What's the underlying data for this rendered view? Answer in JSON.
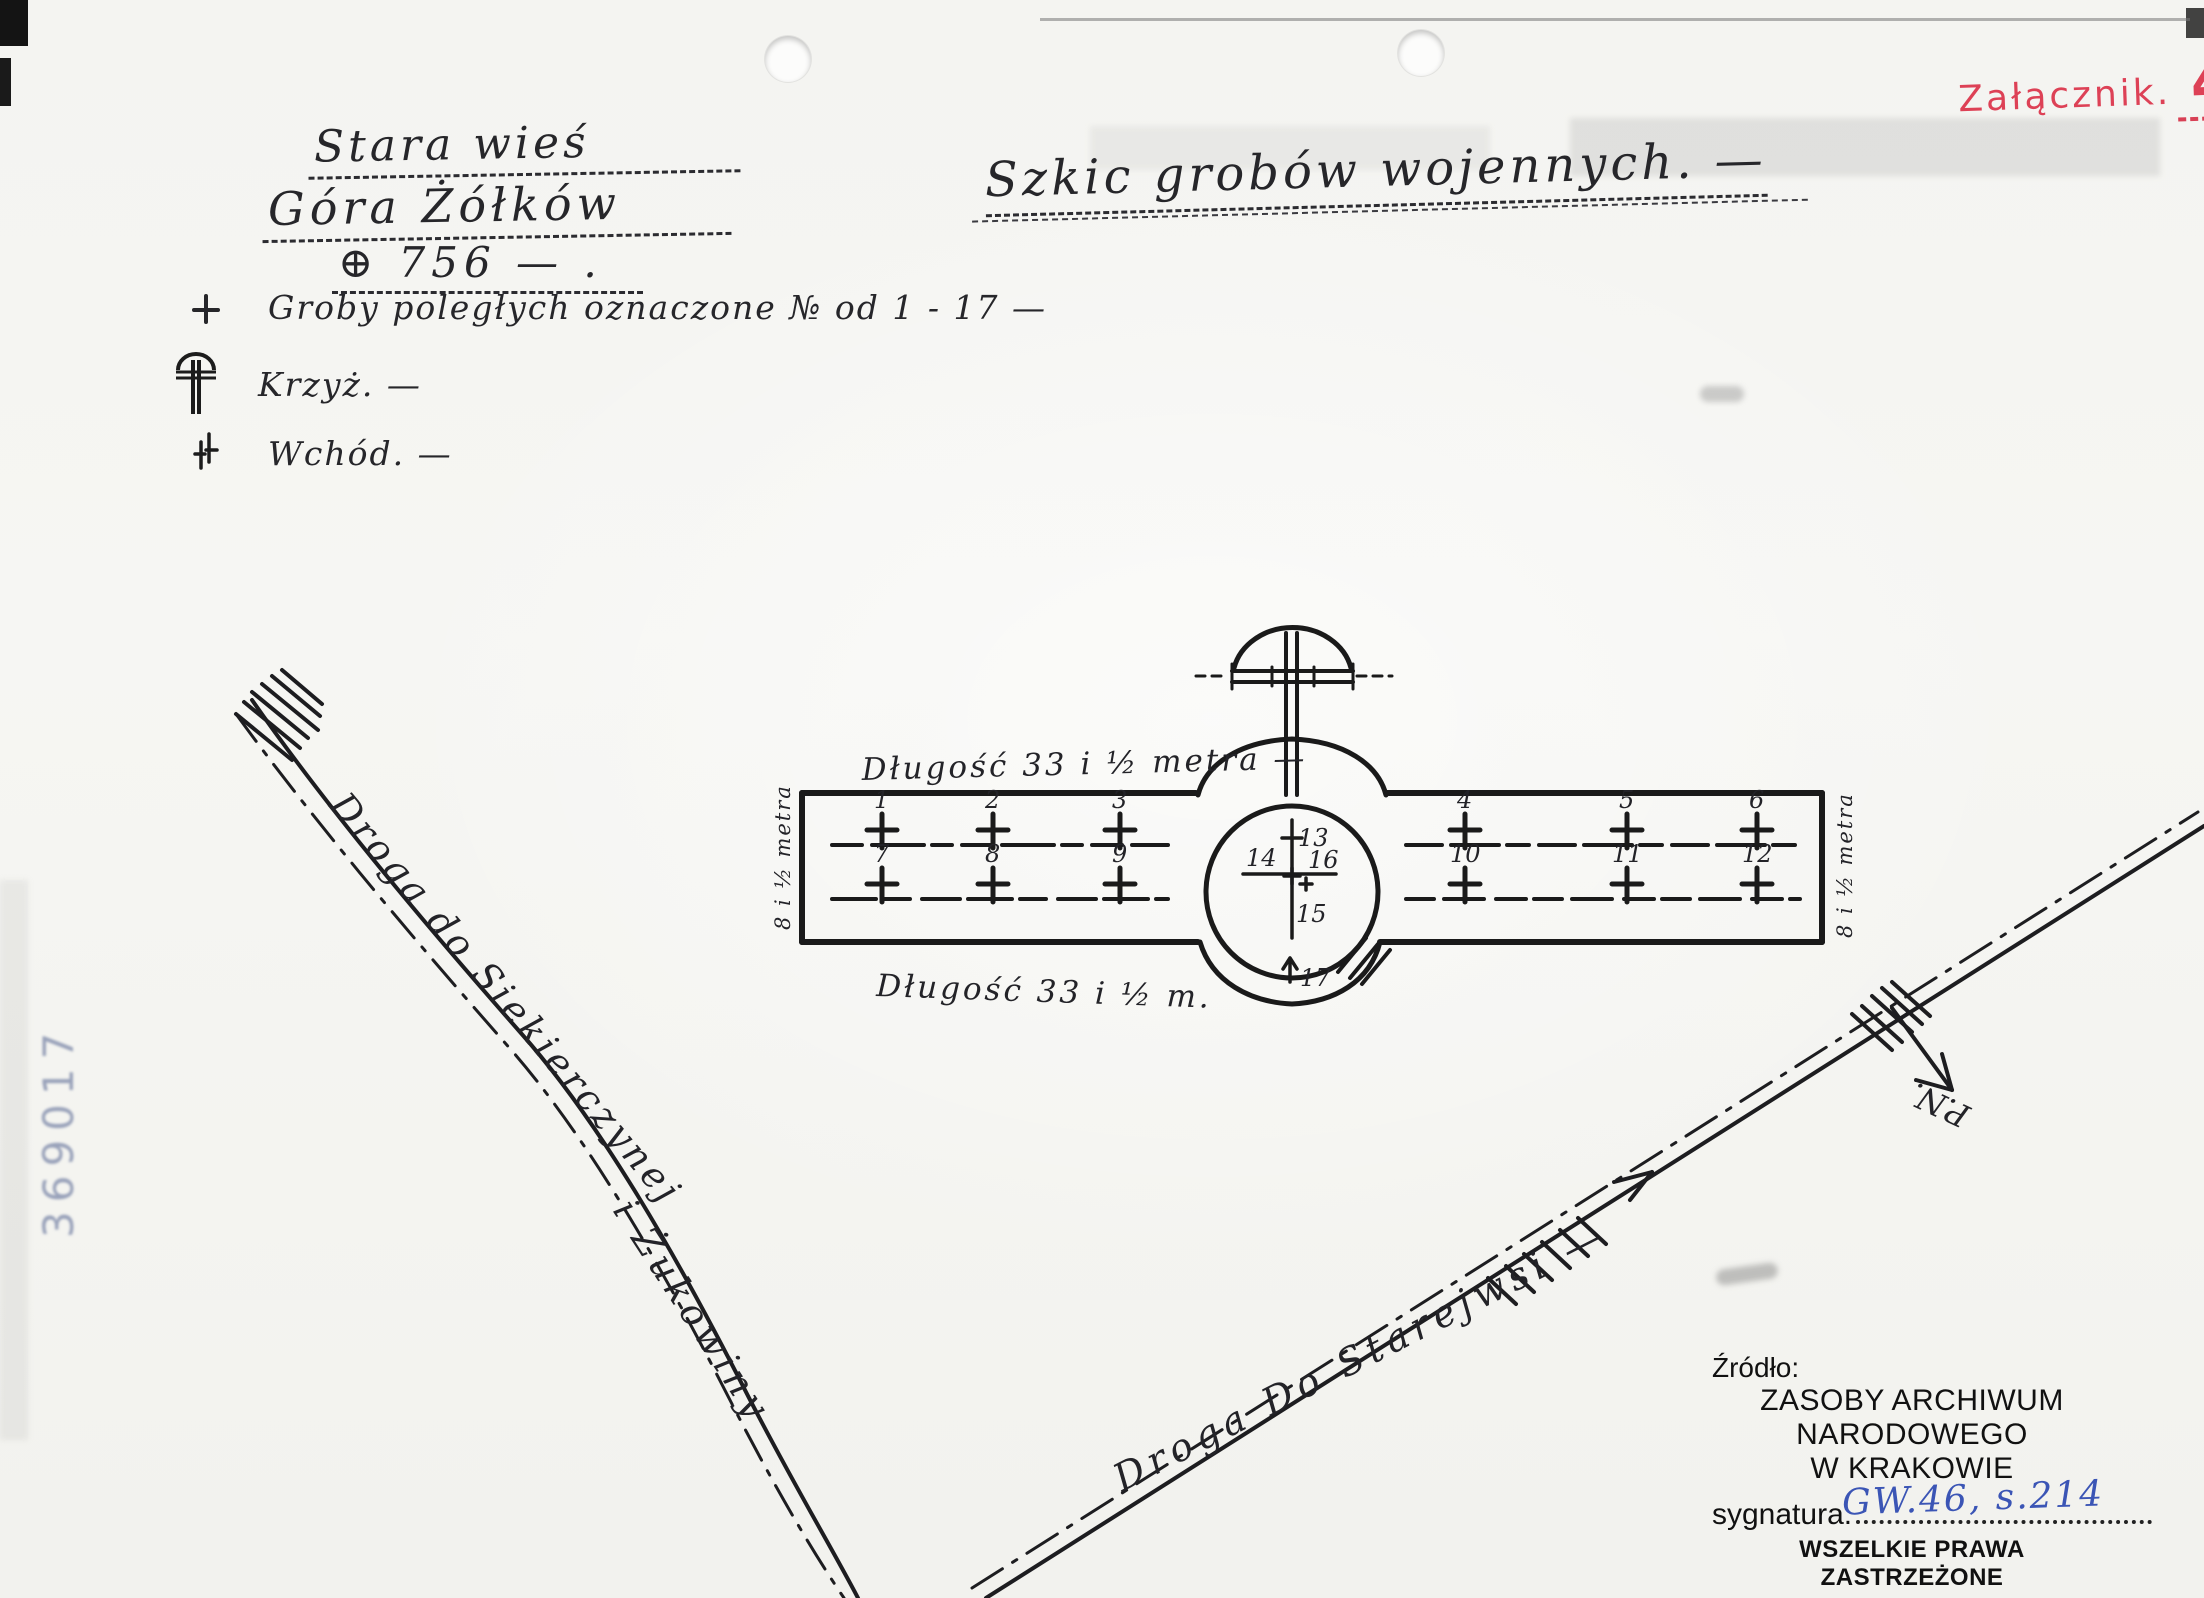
{
  "page": {
    "attachment_label": "Załącznik.",
    "attachment_number": "4",
    "stamp_number": "369017"
  },
  "header": {
    "location_line1": "Stara wieś",
    "location_line2": "Góra Żółków",
    "elevation": "⊕ 756 — .",
    "title": "Szkic grobów wojennych. —"
  },
  "legend": {
    "items": [
      {
        "symbol": "grave-cross",
        "label": "Groby poległych oznaczone № od 1 - 17 —"
      },
      {
        "symbol": "monument-cross",
        "label": "Krzyż. —"
      },
      {
        "symbol": "entrance",
        "label": "Wchód. —"
      }
    ]
  },
  "diagram": {
    "length_label_top": "Długość 33 i ½ metra —",
    "length_label_bottom": "Długość 33 i ½ m.",
    "width_label_left": "8 i ½ metra",
    "width_label_right": "8 i ½ metra",
    "graves_left_top": [
      "1",
      "2",
      "3"
    ],
    "graves_left_bottom": [
      "7",
      "8",
      "9"
    ],
    "graves_right_top": [
      "4",
      "5",
      "6"
    ],
    "graves_right_bottom": [
      "10",
      "11",
      "12"
    ],
    "circle_graves": {
      "top": "13",
      "left": "14",
      "bottom": "15",
      "right": "16",
      "entrance": "17"
    }
  },
  "roads": {
    "left_label_part1": "Droga do Siekierczynej",
    "left_label_part2": "i Żukowiny",
    "right_label": "Droga Do Starejwsi —",
    "north_label": "P.N."
  },
  "source_block": {
    "line1": "Źródło:",
    "line2": "ZASOBY ARCHIWUM NARODOWEGO",
    "line3": "W KRAKOWIE",
    "signature_label": "sygnatura.",
    "signature_value": "GW.46, s.214",
    "rights": "WSZELKIE PRAWA ZASTRZEŻONE",
    "credit_prefix": "© Opracowanie:",
    "credit_name": "Jerzy DROGOMIR"
  }
}
